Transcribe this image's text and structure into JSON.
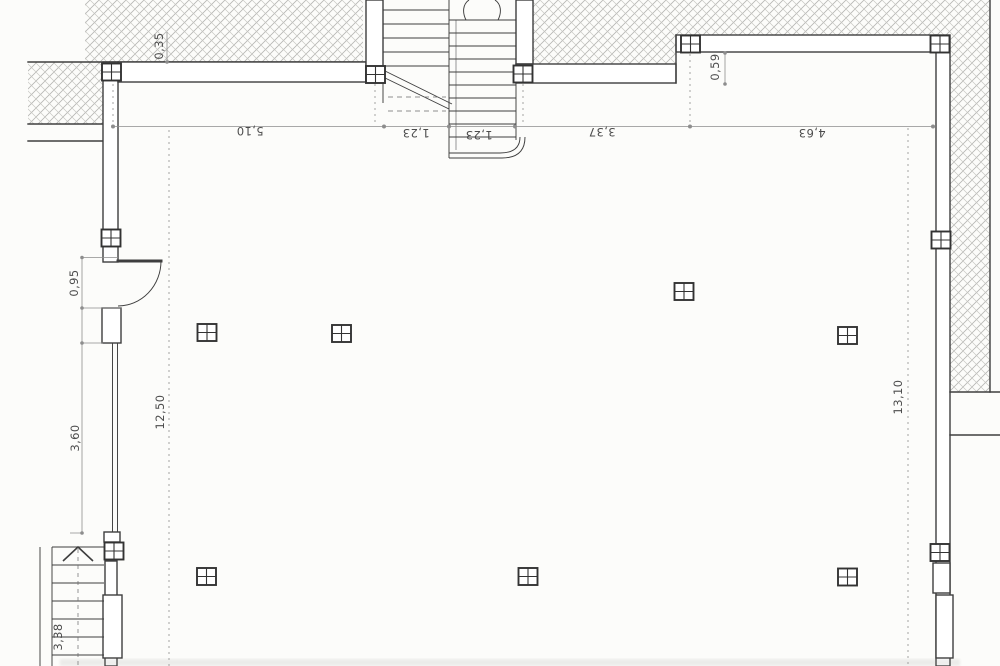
{
  "drawing": {
    "kind": "scanned architectural floor plan",
    "colors": {
      "paper": "#fcfcfa",
      "ink": "#3e3e3e",
      "dim": "#8d8d8d",
      "hatch": "#b6b6b3",
      "txt": "#4c4c4c"
    }
  },
  "dimensions": {
    "top_chain": [
      {
        "value": "5,10"
      },
      {
        "value": "1,23"
      },
      {
        "value": "1,23"
      },
      {
        "value": "3,37"
      },
      {
        "value": "4,63"
      }
    ],
    "wall_thickness": {
      "value": "0,35"
    },
    "top_right_offset": {
      "value": "0,59"
    },
    "door_opening": {
      "value": "0,95"
    },
    "left_wall_segment": {
      "value": "3,60"
    },
    "room_depth_left": {
      "value": "12,50"
    },
    "room_depth_right": {
      "value": "13,10"
    },
    "lower_stair_run": {
      "value": "3,38"
    }
  },
  "symbols": {
    "column_marker": {
      "icon": "plus-square-icon",
      "count": 16
    },
    "upper_staircase": "double flight with break line and curved end",
    "lower_staircase": "single flight with up arrow",
    "door": "quarter-circle swing"
  }
}
